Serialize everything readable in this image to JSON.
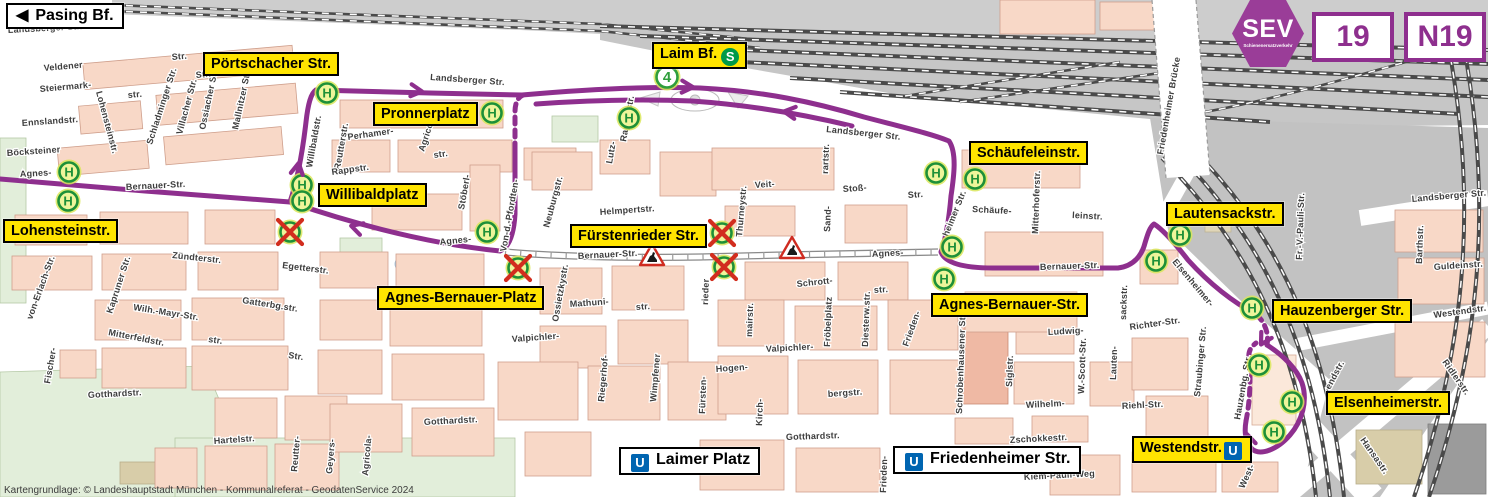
{
  "header": {
    "sev_label": "SEV",
    "sev_sub": "Schienenersatzverkehr",
    "line_badges": [
      "19",
      "N19"
    ]
  },
  "icons": {
    "u_bahn": "U",
    "s_bahn": "S",
    "bus_stop": "H",
    "tram_line": "4",
    "direction_arrow": "◀"
  },
  "colors": {
    "route": "#8e2f8e",
    "sev": "#9a3d98",
    "label_yellow": "#ffe400",
    "stop_green": "#1d9038",
    "stop_fill": "#eef59a",
    "stop_halo": "#d9e65a",
    "closed_red": "#d22d1e",
    "ubahn_blue": "#0065b1",
    "sbahn_green": "#009a49",
    "building": "#f8d8c7",
    "building_stroke": "#cf9f8c",
    "green_area": "#e2eeda",
    "rail_gray": "#c9c9c9",
    "water": "#b8d8ee"
  },
  "labels": [
    {
      "id": "pasing-bf",
      "text": "Pasing Bf.",
      "style": "white",
      "arrow": "left",
      "x": 6,
      "y": 3
    },
    {
      "id": "portschacher-str",
      "text": "Pörtschacher Str.",
      "style": "yellow",
      "x": 203,
      "y": 52
    },
    {
      "id": "pronnerplatz",
      "text": "Pronnerplatz",
      "style": "yellow",
      "x": 373,
      "y": 102
    },
    {
      "id": "laim-bf",
      "text": "Laim Bf.",
      "style": "yellow",
      "icon_after": "s",
      "x": 652,
      "y": 42
    },
    {
      "id": "schaeufeleinstr",
      "text": "Schäufeleinstr.",
      "style": "yellow",
      "x": 969,
      "y": 141
    },
    {
      "id": "willibaldplatz",
      "text": "Willibaldplatz",
      "style": "yellow",
      "x": 318,
      "y": 183
    },
    {
      "id": "lohensteinstr",
      "text": "Lohensteinstr.",
      "style": "yellow",
      "x": 3,
      "y": 219
    },
    {
      "id": "fuerstenrieder-str",
      "text": "Fürstenrieder Str.",
      "style": "yellow",
      "x": 570,
      "y": 224
    },
    {
      "id": "agnes-bernauer-platz",
      "text": "Agnes-Bernauer-Platz",
      "style": "yellow",
      "x": 377,
      "y": 286
    },
    {
      "id": "agnes-bernauer-str",
      "text": "Agnes-Bernauer-Str.",
      "style": "yellow",
      "x": 931,
      "y": 293
    },
    {
      "id": "lautensackstr",
      "text": "Lautensackstr.",
      "style": "yellow",
      "x": 1166,
      "y": 202
    },
    {
      "id": "hauzenberger-str",
      "text": "Hauzenberger Str.",
      "style": "yellow",
      "x": 1272,
      "y": 299
    },
    {
      "id": "elsenheimerstr",
      "text": "Elsenheimerstr.",
      "style": "yellow",
      "x": 1326,
      "y": 391
    },
    {
      "id": "westendstr",
      "text": "Westendstr.",
      "style": "yellow",
      "icon_after": "u",
      "x": 1132,
      "y": 436
    },
    {
      "id": "laimer-platz",
      "text": "Laimer Platz",
      "style": "white",
      "icon_before": "u",
      "x": 619,
      "y": 447
    },
    {
      "id": "friedenheimer-str",
      "text": "Friedenheimer Str.",
      "style": "white",
      "icon_before": "u",
      "x": 893,
      "y": 446
    }
  ],
  "map": {
    "copyright": "Kartengrundlage: © Landeshauptstadt München - Kommunalreferat - GeodatenService 2024",
    "tram_badge": {
      "line": "4",
      "x": 667,
      "y": 77
    },
    "stops": [
      [
        69,
        172
      ],
      [
        68,
        201
      ],
      [
        302,
        185
      ],
      [
        302,
        201
      ],
      [
        327,
        93
      ],
      [
        492,
        113
      ],
      [
        629,
        118
      ],
      [
        487,
        232
      ],
      [
        936,
        173
      ],
      [
        975,
        179
      ],
      [
        952,
        247
      ],
      [
        944,
        279
      ],
      [
        1180,
        235
      ],
      [
        1156,
        261
      ],
      [
        1252,
        308
      ],
      [
        1259,
        365
      ],
      [
        1292,
        402
      ],
      [
        1274,
        432
      ]
    ],
    "closed_stops": [
      [
        290,
        232
      ],
      [
        518,
        268
      ],
      [
        722,
        233
      ],
      [
        724,
        267
      ]
    ],
    "construction": [
      [
        652,
        256
      ],
      [
        792,
        249
      ]
    ],
    "route_arrows": [
      {
        "x": 418,
        "y": 91,
        "a": 6
      },
      {
        "x": 689,
        "y": 87,
        "a": 3
      },
      {
        "x": 788,
        "y": 112,
        "a": 187
      },
      {
        "x": 355,
        "y": 227,
        "a": 197
      },
      {
        "x": 298,
        "y": 167,
        "a": -80
      },
      {
        "x": 1263,
        "y": 341,
        "a": 120
      },
      {
        "x": 1248,
        "y": 438,
        "a": -105
      }
    ],
    "street_labels": [
      {
        "t": "Landsberger Str.",
        "x": 8,
        "y": 33,
        "r": -3
      },
      {
        "t": "Veldener",
        "x": 44,
        "y": 71,
        "r": -5
      },
      {
        "t": "Steiermark-",
        "x": 40,
        "y": 92,
        "r": -5
      },
      {
        "t": "Ennslandstr.",
        "x": 22,
        "y": 126,
        "r": -4
      },
      {
        "t": "Böcksteiner",
        "x": 7,
        "y": 156,
        "r": -4
      },
      {
        "t": "Agnes-",
        "x": 20,
        "y": 177,
        "r": -3
      },
      {
        "t": "Bernauer-Str.",
        "x": 126,
        "y": 190,
        "r": -3
      },
      {
        "t": "Lohensteinstr.",
        "x": 96,
        "y": 92,
        "r": 75
      },
      {
        "t": "Str.",
        "x": 172,
        "y": 60,
        "r": -5
      },
      {
        "t": "str.",
        "x": 128,
        "y": 98,
        "r": -5
      },
      {
        "t": "Schladminger Str.",
        "x": 152,
        "y": 145,
        "r": -72
      },
      {
        "t": "Villacher Str.",
        "x": 182,
        "y": 135,
        "r": -75
      },
      {
        "t": "Ossiacher Str.",
        "x": 205,
        "y": 130,
        "r": -78
      },
      {
        "t": "Mallnitzer Str.",
        "x": 238,
        "y": 130,
        "r": -78
      },
      {
        "t": "Str.",
        "x": 196,
        "y": 78,
        "r": -5
      },
      {
        "t": "Willibaldstr.",
        "x": 312,
        "y": 168,
        "r": -80
      },
      {
        "t": "Reutterstr.",
        "x": 340,
        "y": 170,
        "r": -80
      },
      {
        "t": "Perhamer-",
        "x": 348,
        "y": 140,
        "r": -8
      },
      {
        "t": "str.",
        "x": 434,
        "y": 158,
        "r": -8
      },
      {
        "t": "Agricolastr.",
        "x": 424,
        "y": 152,
        "r": -72
      },
      {
        "t": "Rappstr.",
        "x": 332,
        "y": 175,
        "r": -8
      },
      {
        "t": "Stöberl-",
        "x": 464,
        "y": 210,
        "r": -80
      },
      {
        "t": "Von-d.-Pfordten-",
        "x": 506,
        "y": 252,
        "r": -80
      },
      {
        "t": "Agnes-",
        "x": 440,
        "y": 245,
        "r": -6
      },
      {
        "t": "Bernauer-Str.",
        "x": 578,
        "y": 259,
        "r": -3
      },
      {
        "t": "Neuburgstr.",
        "x": 549,
        "y": 228,
        "r": -75
      },
      {
        "t": "Helmpertstr.",
        "x": 600,
        "y": 215,
        "r": -4
      },
      {
        "t": "Rapotostr.",
        "x": 626,
        "y": 142,
        "r": -80
      },
      {
        "t": "Lutz-",
        "x": 612,
        "y": 164,
        "r": -80
      },
      {
        "t": "Mathuni-",
        "x": 570,
        "y": 307,
        "r": -4
      },
      {
        "t": "str.",
        "x": 636,
        "y": 310,
        "r": -4
      },
      {
        "t": "Ossietzkystr.",
        "x": 558,
        "y": 322,
        "r": -80
      },
      {
        "t": "Valpichler-",
        "x": 512,
        "y": 342,
        "r": -4
      },
      {
        "t": "Valpichler-",
        "x": 766,
        "y": 352,
        "r": -3
      },
      {
        "t": "rieder",
        "x": 708,
        "y": 305,
        "r": -88
      },
      {
        "t": "Fürsten-",
        "x": 705,
        "y": 414,
        "r": -88
      },
      {
        "t": "Riegerhof-",
        "x": 604,
        "y": 402,
        "r": -85
      },
      {
        "t": "Wimpfener",
        "x": 656,
        "y": 402,
        "r": -85
      },
      {
        "t": "Hogen-",
        "x": 716,
        "y": 372,
        "r": -4
      },
      {
        "t": "bergstr.",
        "x": 828,
        "y": 397,
        "r": -4
      },
      {
        "t": "Kirch-",
        "x": 762,
        "y": 426,
        "r": -88
      },
      {
        "t": "Veit-",
        "x": 755,
        "y": 188,
        "r": -4
      },
      {
        "t": "Thurneystr.",
        "x": 742,
        "y": 237,
        "r": -85
      },
      {
        "t": "Stoß-",
        "x": 843,
        "y": 192,
        "r": -4
      },
      {
        "t": "Sand-",
        "x": 830,
        "y": 232,
        "r": -88
      },
      {
        "t": "rartstr.",
        "x": 828,
        "y": 174,
        "r": -88
      },
      {
        "t": "Str.",
        "x": 908,
        "y": 198,
        "r": -4
      },
      {
        "t": "Schrott-",
        "x": 797,
        "y": 287,
        "r": -6
      },
      {
        "t": "str.",
        "x": 874,
        "y": 293,
        "r": -4
      },
      {
        "t": "mairstr.",
        "x": 752,
        "y": 337,
        "r": -88
      },
      {
        "t": "Fröbelplatz",
        "x": 830,
        "y": 347,
        "r": -88
      },
      {
        "t": "Diesterw.str.",
        "x": 868,
        "y": 347,
        "r": -88
      },
      {
        "t": "Frieden-",
        "x": 908,
        "y": 347,
        "r": -70
      },
      {
        "t": "heimer Str.",
        "x": 948,
        "y": 237,
        "r": -68
      },
      {
        "t": "Landsberger Str.",
        "x": 430,
        "y": 80,
        "r": 4
      },
      {
        "t": "Landsberger Str.",
        "x": 826,
        "y": 132,
        "r": 6
      },
      {
        "t": "Landsberger Str.",
        "x": 1412,
        "y": 202,
        "r": -5
      },
      {
        "t": "Schäufe-",
        "x": 972,
        "y": 212,
        "r": 3
      },
      {
        "t": "leinstr.",
        "x": 1072,
        "y": 218,
        "r": 3
      },
      {
        "t": "Mitterhoferstr.",
        "x": 1038,
        "y": 234,
        "r": -88
      },
      {
        "t": "Friedenheimer Brücke",
        "x": 1163,
        "y": 155,
        "r": -80
      },
      {
        "t": "Schrobenhausener Str.",
        "x": 962,
        "y": 414,
        "r": -88
      },
      {
        "t": "Siglstr.",
        "x": 1012,
        "y": 387,
        "r": -88
      },
      {
        "t": "Ludwig-",
        "x": 1048,
        "y": 335,
        "r": -3
      },
      {
        "t": "W.-Scott-Str.",
        "x": 1084,
        "y": 394,
        "r": -88
      },
      {
        "t": "Lauten-",
        "x": 1116,
        "y": 380,
        "r": -88
      },
      {
        "t": "sackstr.",
        "x": 1126,
        "y": 320,
        "r": -88
      },
      {
        "t": "Richter-Str.",
        "x": 1130,
        "y": 330,
        "r": -8
      },
      {
        "t": "Riehl-Str.",
        "x": 1122,
        "y": 409,
        "r": -3
      },
      {
        "t": "Wilhelm-",
        "x": 1026,
        "y": 408,
        "r": -3
      },
      {
        "t": "Zschokkestr.",
        "x": 1010,
        "y": 443,
        "r": -3
      },
      {
        "t": "Kiem-Pauli-Weg",
        "x": 1024,
        "y": 480,
        "r": -3
      },
      {
        "t": "Gotthardstr.",
        "x": 88,
        "y": 398,
        "r": -3
      },
      {
        "t": "Gotthardstr.",
        "x": 424,
        "y": 425,
        "r": -3
      },
      {
        "t": "Gotthardstr.",
        "x": 786,
        "y": 440,
        "r": -2
      },
      {
        "t": "Hartelstr.",
        "x": 214,
        "y": 444,
        "r": -4
      },
      {
        "t": "Reutter-",
        "x": 297,
        "y": 472,
        "r": -85
      },
      {
        "t": "Geyers-",
        "x": 332,
        "y": 474,
        "r": -85
      },
      {
        "t": "Agricola-",
        "x": 368,
        "y": 476,
        "r": -85
      },
      {
        "t": "Wilh.-Mayr-Str.",
        "x": 133,
        "y": 310,
        "r": 9
      },
      {
        "t": "Mitterfeldstr.",
        "x": 108,
        "y": 335,
        "r": 11
      },
      {
        "t": "Kapruner Str.",
        "x": 112,
        "y": 314,
        "r": -72
      },
      {
        "t": "von-Erlach-Str.",
        "x": 32,
        "y": 320,
        "r": -70
      },
      {
        "t": "Fischer-",
        "x": 50,
        "y": 384,
        "r": -80
      },
      {
        "t": "Gatterbg.str.",
        "x": 242,
        "y": 303,
        "r": 9
      },
      {
        "t": "str.",
        "x": 208,
        "y": 342,
        "r": 8
      },
      {
        "t": "Str.",
        "x": 288,
        "y": 358,
        "r": 8
      },
      {
        "t": "Zündterstr.",
        "x": 172,
        "y": 258,
        "r": 6
      },
      {
        "t": "Egetterstr.",
        "x": 282,
        "y": 268,
        "r": 7
      },
      {
        "t": "Agnes-",
        "x": 872,
        "y": 257,
        "r": -3
      },
      {
        "t": "Bernauer-Str.",
        "x": 1040,
        "y": 270,
        "r": -2
      },
      {
        "t": "Elsenheimer-",
        "x": 1172,
        "y": 262,
        "r": 50
      },
      {
        "t": "Fr.-V.-Pauli-Str.",
        "x": 1302,
        "y": 260,
        "r": -88
      },
      {
        "t": "Barthstr.",
        "x": 1422,
        "y": 264,
        "r": -88
      },
      {
        "t": "Guldeinstr.",
        "x": 1434,
        "y": 270,
        "r": -4
      },
      {
        "t": "Westendstr.",
        "x": 1434,
        "y": 318,
        "r": -8
      },
      {
        "t": "Ridlerstr.",
        "x": 1442,
        "y": 362,
        "r": 55
      },
      {
        "t": "Hansastr.",
        "x": 1360,
        "y": 440,
        "r": 55
      },
      {
        "t": "Straubinger Str.",
        "x": 1200,
        "y": 397,
        "r": -85
      },
      {
        "t": "Hauzenbg. Str.",
        "x": 1240,
        "y": 420,
        "r": -80
      },
      {
        "t": "West-",
        "x": 1244,
        "y": 489,
        "r": -65
      },
      {
        "t": "endstr.",
        "x": 1330,
        "y": 390,
        "r": -62
      },
      {
        "t": "Frieden-",
        "x": 886,
        "y": 493,
        "r": -88
      }
    ]
  }
}
